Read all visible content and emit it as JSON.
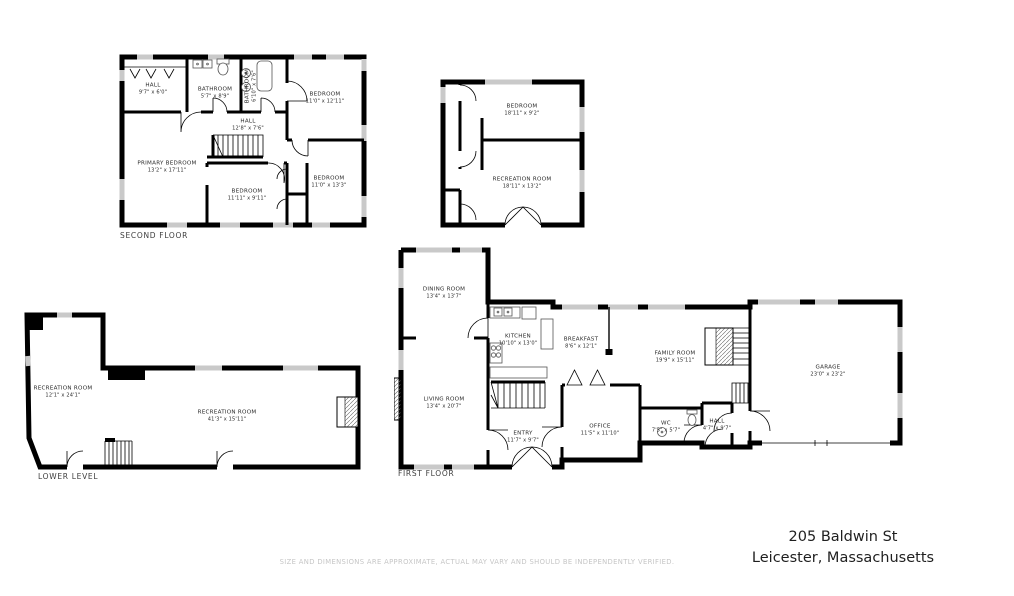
{
  "address": {
    "line1": "205 Baldwin St",
    "line2": "Leicester, Massachusetts"
  },
  "disclaimer": "SIZE AND DIMENSIONS ARE APPROXIMATE, ACTUAL MAY VARY AND SHOULD BE INDEPENDENTLY VERIFIED.",
  "colors": {
    "wall": "#000000",
    "window": "#c9c9c9",
    "label_text": "#2b2b2b",
    "disclaimer_text": "#c6c6c6"
  },
  "floors": {
    "second": {
      "title": "SECOND FLOOR",
      "rooms": [
        {
          "name": "HALL",
          "dims": "9'7\" x 6'0\""
        },
        {
          "name": "BATHROOM",
          "dims": "5'7\" x 8'9\""
        },
        {
          "name": "BATHROOM",
          "dims": "6'10\" x 7'6\""
        },
        {
          "name": "BEDROOM",
          "dims": "11'0\" x 12'11\""
        },
        {
          "name": "HALL",
          "dims": "12'8\" x 7'6\""
        },
        {
          "name": "PRIMARY BEDROOM",
          "dims": "13'2\" x 17'11\""
        },
        {
          "name": "BEDROOM",
          "dims": "11'11\" x 9'11\""
        },
        {
          "name": "BEDROOM",
          "dims": "11'0\" x 13'3\""
        }
      ]
    },
    "upper_unit": {
      "rooms": [
        {
          "name": "BEDROOM",
          "dims": "18'11\" x 9'2\""
        },
        {
          "name": "RECREATION ROOM",
          "dims": "18'11\" x 13'2\""
        }
      ]
    },
    "lower": {
      "title": "LOWER LEVEL",
      "rooms": [
        {
          "name": "RECREATION ROOM",
          "dims": "12'1\" x 24'1\""
        },
        {
          "name": "RECREATION ROOM",
          "dims": "41'3\" x 15'11\""
        }
      ]
    },
    "first": {
      "title": "FIRST FLOOR",
      "rooms": [
        {
          "name": "DINING ROOM",
          "dims": "13'4\" x 13'7\""
        },
        {
          "name": "KITCHEN",
          "dims": "10'10\" x 13'0\""
        },
        {
          "name": "BREAKFAST",
          "dims": "8'6\" x 12'1\""
        },
        {
          "name": "FAMILY ROOM",
          "dims": "19'9\" x 15'11\""
        },
        {
          "name": "LIVING ROOM",
          "dims": "13'4\" x 20'7\""
        },
        {
          "name": "ENTRY",
          "dims": "11'7\" x 9'7\""
        },
        {
          "name": "OFFICE",
          "dims": "11'5\" x 11'10\""
        },
        {
          "name": "WC",
          "dims": "7'5\" x 5'7\""
        },
        {
          "name": "HALL",
          "dims": "4'7\" x 9'7\""
        },
        {
          "name": "GARAGE",
          "dims": "23'0\" x 23'2\""
        }
      ]
    }
  }
}
